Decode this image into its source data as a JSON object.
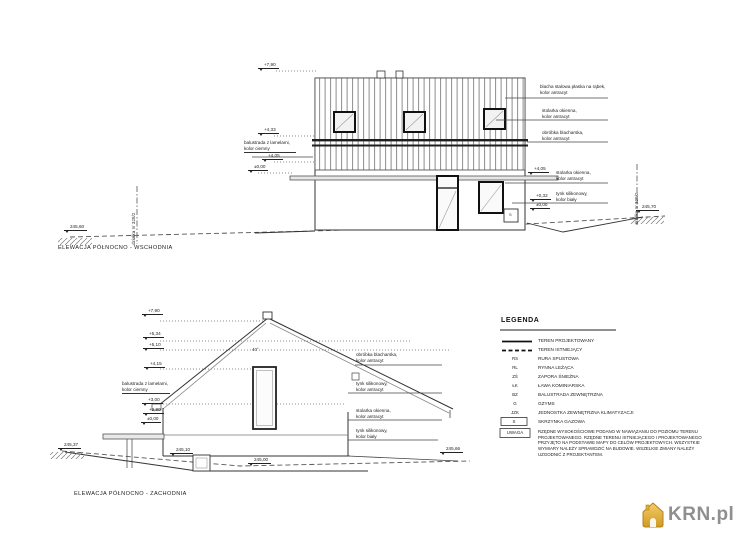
{
  "top": {
    "caption": "ELEWACJA PÓŁNOCNO - WSCHODNIA",
    "plot_left": "działka nr 328/2",
    "plot_right": "działka nr 328/2",
    "levels": [
      "+7,90",
      "+4,33",
      "+4,05",
      "±0,00",
      "+4,05",
      "+0,32",
      "±0,00"
    ],
    "grounds": [
      "245,60",
      "245,70"
    ],
    "wall_label": "balustrada z lamelami,\nkolor ciemny",
    "sbox": "S",
    "annos": [
      "blacha stalowa płaska na rąbek,\nkolor antracyt",
      "stolarka okienna,\nkolor antracyt",
      "obróbka blacharska,\nkolor antracyt",
      "stolarka okienna,\nkolor antracyt",
      "tynk silikonowy,\nkolor biały"
    ]
  },
  "bottom": {
    "caption": "ELEWACJA PÓŁNOCNO - ZACHODNIA",
    "levels": [
      "+7,90",
      "+5,34",
      "+5,10",
      "+4,15",
      "+3,00",
      "+2,80",
      "±0,00"
    ],
    "grounds": [
      "245,37",
      "245,10",
      "245,00",
      "245,66"
    ],
    "wall_label": "balustrada z lamelami,\nkolor ciemny",
    "pitch": "40°",
    "annos": [
      "obróbka blacharska,\nkolor antracyt",
      "tynk silikonowy,\nkolor antracyt",
      "stolarka okienna,\nkolor antracyt",
      "tynk silikonowy,\nkolor biały"
    ]
  },
  "legend": {
    "title": "LEGENDA",
    "rows": [
      {
        "sym": "",
        "label": "TEREN PROJEKTOWANY"
      },
      {
        "sym": "",
        "label": "TEREN ISTNIEJĄCY"
      },
      {
        "sym": "RS",
        "label": "RURA SPUSTOWA"
      },
      {
        "sym": "RL",
        "label": "RYNNA LEŻĄCA"
      },
      {
        "sym": "ZŚ",
        "label": "ZAPORA ŚNIEŻNA"
      },
      {
        "sym": "ŁK",
        "label": "ŁAWA KOMINIARSKA"
      },
      {
        "sym": "BZ",
        "label": "BALUSTRADA ZEWNĘTRZNA"
      },
      {
        "sym": "G",
        "label": "GZYMS"
      },
      {
        "sym": "JZK",
        "label": "JEDNOSTKA ZEWNĘTRZNA KLIMATYZACJI"
      },
      {
        "sym": "S",
        "label": "SKRZYNKA GAZOWA"
      },
      {
        "sym": "UWAGA",
        "label": "RZĘDNE WYSOKOŚCIOWE PODANO W NAWIĄZANIU DO POZIOMU TERENU PROJEKTOWANEGO. RZĘDNE TERENU ISTNIEJĄCEGO I PROJEKTOWANEGO PRZYJĘTO NA PODSTAWIE MAPY DO CELÓW PROJEKTOWYCH. WSZYSTKIE WYMIARY NALEŻY SPRAWDZIĆ NA BUDOWIE. WSZELKIE ZMIANY NALEŻY UZGODNIĆ Z PROJEKTANTEM."
      }
    ]
  },
  "logo": {
    "text": "KRN.pl"
  }
}
